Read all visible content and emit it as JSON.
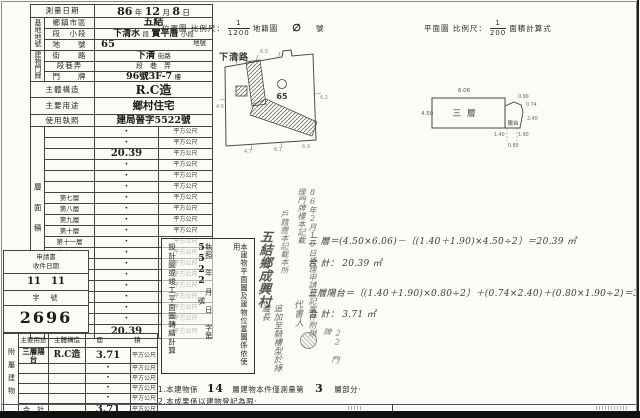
{
  "headers": {
    "map_title": "位置圖",
    "map_scale_label": "比例尺：",
    "map_scale_num": "1",
    "map_scale_den": "1200",
    "map_suffix1": "地籍圖",
    "map_hand_mark": "∅",
    "map_suffix2": "號",
    "plan_title": "平面圖",
    "plan_scale_label": "比例尺：",
    "plan_scale_num": "1",
    "plan_scale_den": "200",
    "plan_suffix": "面積計算式"
  },
  "left_form": {
    "date_label": "測量日期",
    "date_y": "86",
    "date_y_u": "年",
    "date_m": "12",
    "date_m_u": "月",
    "date_d": "8",
    "date_d_u": "日",
    "site_group": "基地地號",
    "township_label": "鄉鎮市區",
    "township_value": "五結",
    "section_label": "段　小段",
    "section_p0": "下清水",
    "section_p1": "段",
    "section_p2": "實平厝",
    "section_p3": "小段",
    "lot_label": "地　　號",
    "lot_value": "65",
    "lot_suffix": "地號",
    "door_group": "建物門牌",
    "street_label": "街　　路",
    "street_value": "下清",
    "street_suffix": "街路",
    "lane_label": "段巷弄",
    "lane_value": "段　巷　弄",
    "door_label": "門　　牌",
    "door_value": "96號3F-7",
    "door_suffix": "樓",
    "structure_label": "主體構造",
    "structure_value": "R.C造",
    "use_label": "主要用途",
    "use_value": "鄉村住宅",
    "license_label": "使用執照",
    "license_value": "建局晉字5522號"
  },
  "floor_area": {
    "group": "層面積",
    "group_sub": "（平方公尺）",
    "unit": "平方公尺",
    "rows": [
      {
        "label": "",
        "value": "·"
      },
      {
        "label": "",
        "value": "·"
      },
      {
        "label": "",
        "value": "20.39"
      },
      {
        "label": "",
        "value": "·"
      },
      {
        "label": "",
        "value": "·"
      },
      {
        "label": "",
        "value": "·"
      },
      {
        "label": "第七層",
        "value": "·"
      },
      {
        "label": "第八層",
        "value": "·"
      },
      {
        "label": "第九層",
        "value": "·"
      },
      {
        "label": "第十層",
        "value": "·"
      },
      {
        "label": "第十一層",
        "value": "·"
      },
      {
        "label": "第十二層",
        "value": "·"
      },
      {
        "label": "",
        "value": "·"
      },
      {
        "label": "",
        "value": "·"
      },
      {
        "label": "",
        "value": "·"
      },
      {
        "label": "地下一層",
        "value": "·"
      },
      {
        "label": "地下二層",
        "value": "·"
      },
      {
        "label": "騎　樓",
        "value": "·"
      },
      {
        "label": "合　計",
        "value": "20.39"
      }
    ]
  },
  "receipt": {
    "title_line1": "申請書",
    "title_line2": "收件日期",
    "date_value": "11　11",
    "no_label": "字　號",
    "no_value": "2696"
  },
  "attached": {
    "group": "附屬建物",
    "header_use": "主要用途",
    "header_structure": "主體構造",
    "header_area": "面　　積",
    "unit": "平方公尺",
    "rows": [
      {
        "use": "三層陽台",
        "structure": "R.C造",
        "area": "3.71"
      },
      {
        "use": "",
        "structure": "",
        "area": "·"
      },
      {
        "use": "",
        "structure": "",
        "area": "·"
      },
      {
        "use": "",
        "structure": "",
        "area": "·"
      },
      {
        "use": "",
        "structure": "",
        "area": "·"
      },
      {
        "use": "合　計",
        "structure": "",
        "area": "3.71"
      }
    ]
  },
  "map": {
    "road": "下清路",
    "lot": "65",
    "edge_numbers": [
      "6.6",
      "6.0",
      "4.6",
      "4.7",
      "6.1",
      "6.9",
      "6.2"
    ]
  },
  "plan": {
    "room": "三層",
    "balcony": "陽台",
    "dim_top": "6.06",
    "dim_left": "4.50",
    "dim_b1": "0.90",
    "dim_b2": "0.74",
    "dim_b3": "2.40",
    "dim_b4": "1.90",
    "dim_b5": "1.40",
    "dim_b6": "0.80"
  },
  "note_box": {
    "col_right": "本建物平面圖及建物位置圖係依使用",
    "col_mid_a": "執照",
    "col_mid_b": "年",
    "col_mid_c": "月",
    "col_mid_d": "日",
    "col_mid_e": "字第",
    "col_mid_hand": "5522",
    "col_mid_f": "號",
    "col_left": "設計圖或竣工平面圖轉繪計算"
  },
  "calc": {
    "line1": "三 層＝(4.50×6.06)－〔(1.40＋1.90)×4.50÷2〕＝20.39 ㎡",
    "line2": "合 計： 20.39 ㎡",
    "line3": "三層陽台＝〔(1.40＋1.90)×0.80÷2〕＋(0.74×2.40)＋(0.80×1.90÷2)＝3.71 ㎡",
    "line4": "合 計： 3.71 ㎡"
  },
  "annotations": {
    "hw_dense": "86年2月10日受理申請登記案件附辦理門牌樓本記載",
    "hw_mid": "戶籍謄本記載本所",
    "hw_big": "五結鄉成興村",
    "hw_add": "追加至騎樓型於綠邊長",
    "hw_sign": "代書人",
    "hw_extra": "22 門牌"
  },
  "notes": {
    "n1_a": "1.本建物係",
    "n1_hand1": "14",
    "n1_b": "層建物本件僅測量第",
    "n1_hand2": "3",
    "n1_c": "層部分·",
    "n2": "2.本成果係以建物登記為限·"
  }
}
